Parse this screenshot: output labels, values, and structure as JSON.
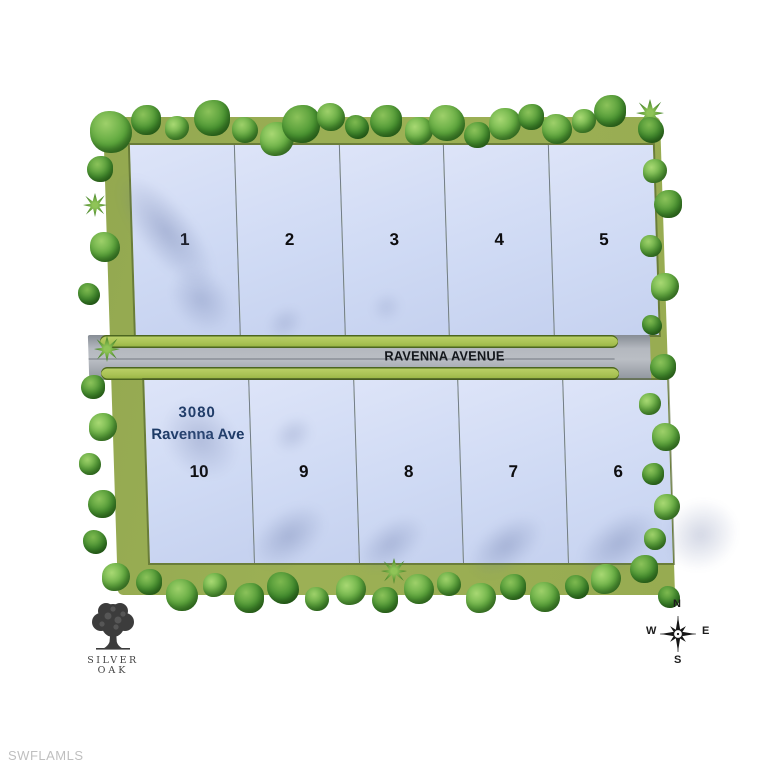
{
  "plat": {
    "road_name": "RAVENNA AVENUE",
    "address": {
      "line1": "3080",
      "line2": "Ravenna Ave"
    },
    "lots": {
      "top_row": [
        "1",
        "2",
        "3",
        "4",
        "5"
      ],
      "bottom_row": [
        "10",
        "9",
        "8",
        "7",
        "6"
      ]
    }
  },
  "compass": {
    "north": "N",
    "east": "E",
    "south": "S",
    "west": "W"
  },
  "logo": {
    "line1": "SILVER",
    "line2": "OAK"
  },
  "watermark": "SWFLAMLS",
  "colors": {
    "lot_fill": "#ccd7f2",
    "grass": "#9cb055",
    "road": "#a9afb7",
    "verge_green": "#a9c254",
    "address_text": "#1d3a66"
  }
}
